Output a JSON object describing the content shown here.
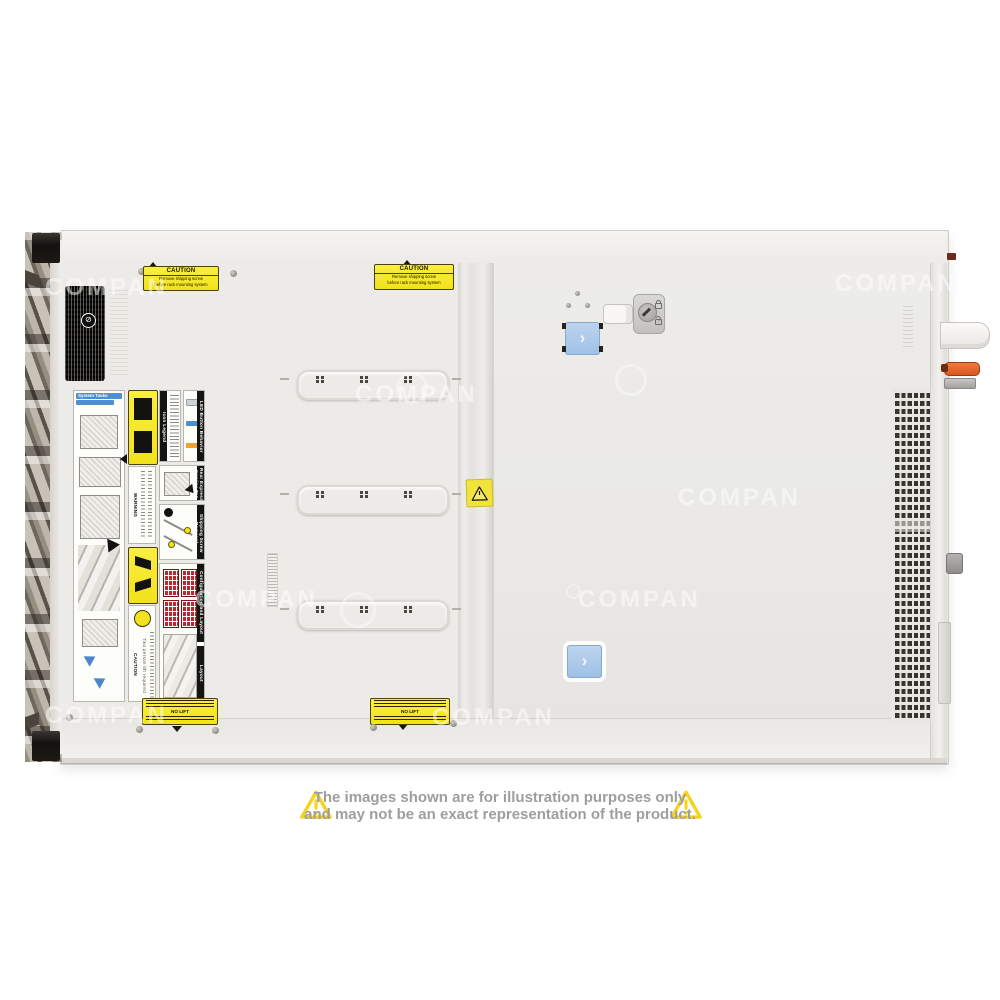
{
  "watermark": {
    "text": "COMPAN"
  },
  "disclaimer": {
    "line1": "The images shown are for illustration purposes only",
    "line2": "and may not be an exact representation of the product.",
    "triangle_color": "#f5d31f",
    "text_color": "#9e9e9e"
  },
  "server": {
    "top_caution": {
      "title": "CAUTION",
      "line1": "Remove shipping screw",
      "line2": "before rack mounting system"
    },
    "bottom_caution": {
      "no_lift": "NO LIFT"
    },
    "labels": {
      "system_tasks": "System Tasks",
      "icon_legend": "Icon Legend",
      "led_behavior": "LED Button Behavior",
      "warning": "WARNING",
      "caution": "CAUTION",
      "two_person": "Two person lift required",
      "rear_service_tag": "Rear Express Service Tag",
      "shipping_screw": "Shipping Screw Removal",
      "config_layout": "Configuration and Layout",
      "layout": "Layout",
      "no_symbol": "⊘"
    },
    "latch_chevron": "›",
    "colors": {
      "latch_blue": "#a9c9ea",
      "handle_orange": "#e2622b",
      "label_yellow": "#f2e21b",
      "chassis_white": "#ebe9e5"
    }
  }
}
